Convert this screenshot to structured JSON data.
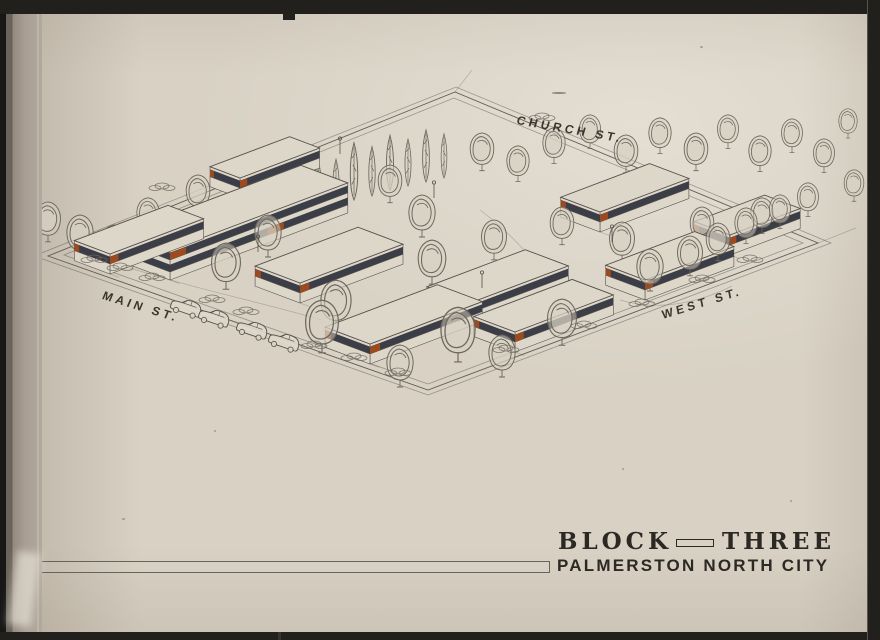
{
  "labels": {
    "church": "CHURCH ST.",
    "main": "MAIN ST.",
    "west": "WEST ST."
  },
  "title": {
    "block": "BLOCK",
    "three": "THREE"
  },
  "subtitle": "PALMERSTON NORTH CITY",
  "colors": {
    "paper": "#d8d1c4",
    "paper_light": "#ddd7ca",
    "ink": "#55504a",
    "tree": "#6e675d",
    "window_band": "#3c3e47",
    "accent_orange": "#9c4a1e",
    "title_ink": "#2c2824",
    "frame_black": "#21201d",
    "binding_gray": "#a79d93",
    "street_label_ink": "#3a352d"
  }
}
